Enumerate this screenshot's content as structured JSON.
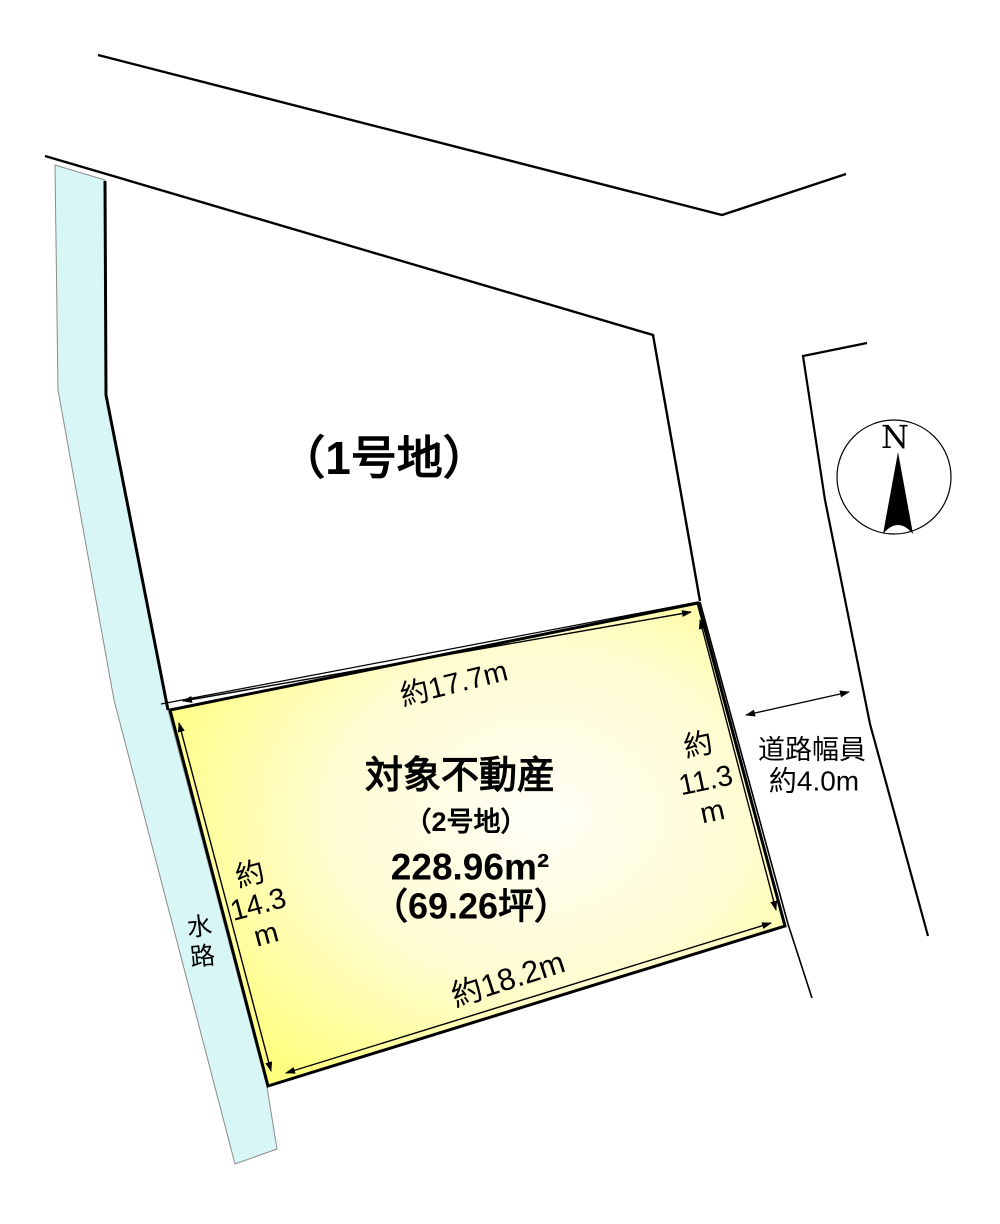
{
  "diagram": {
    "lot1_label": "（1号地）",
    "north_label": "N",
    "target": {
      "title": "対象不動産",
      "lot_label": "（2号地）",
      "area_sqm": "228.96m²",
      "area_tsubo": "（69.26坪）"
    },
    "dims": {
      "top": "約17.7m",
      "bottom": "約18.2m",
      "left": [
        "約",
        "14.3",
        "m"
      ],
      "right": [
        "約",
        "11.3",
        "m"
      ]
    },
    "road": {
      "width_line1": "道路幅員",
      "width_line2": "約4.0m"
    },
    "waterway": {
      "chars": [
        "水",
        "路"
      ]
    },
    "colors": {
      "plot_center": "#FFFFF7",
      "plot_mid": "#FFFCD2",
      "plot_edge": "#FFFF6B",
      "water_fill": "#D9F6F7",
      "water_stroke": "#8A8A8A",
      "line": "#000000"
    }
  }
}
